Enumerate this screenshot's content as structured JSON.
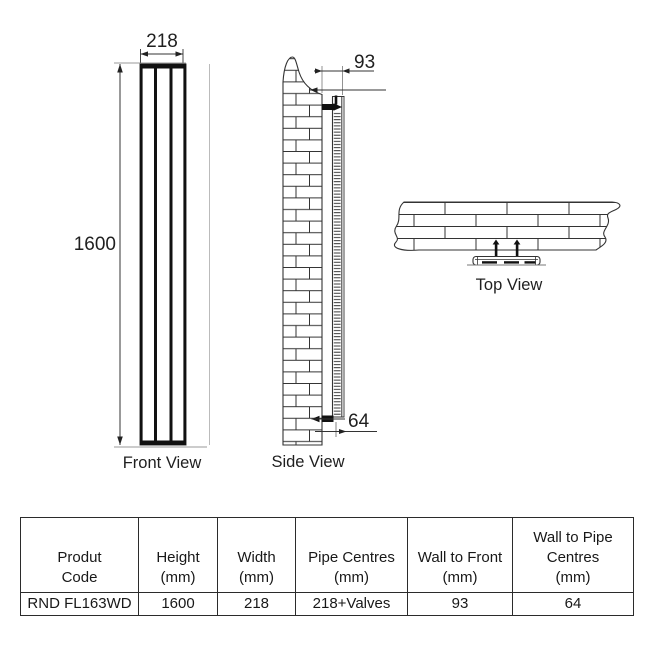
{
  "drawing": {
    "front_view": {
      "label": "Front View",
      "width_mm": "218",
      "height_mm": "1600"
    },
    "side_view": {
      "label": "Side View",
      "wall_to_front_mm": "93",
      "wall_to_pipe_mm": "64"
    },
    "top_view": {
      "label": "Top View"
    }
  },
  "table": {
    "columns": [
      {
        "label": "Produt Code",
        "lines": [
          "Produt",
          "Code"
        ]
      },
      {
        "label": "Height (mm)",
        "lines": [
          "Height",
          "(mm)"
        ]
      },
      {
        "label": "Width (mm)",
        "lines": [
          "Width",
          "(mm)"
        ]
      },
      {
        "label": "Pipe Centres (mm)",
        "lines": [
          "Pipe Centres",
          "(mm)"
        ]
      },
      {
        "label": "Wall to Front (mm)",
        "lines": [
          "Wall to Front",
          "(mm)"
        ]
      },
      {
        "label": "Wall to Pipe Centres (mm)",
        "lines": [
          "Wall to Pipe",
          "Centres",
          "(mm)"
        ]
      }
    ],
    "row": [
      "RND FL163WD",
      "1600",
      "218",
      "218+Valves",
      "93",
      "64"
    ]
  },
  "colors": {
    "line": "#333333",
    "dark_fill": "#111111",
    "light_line": "#8a8a8a",
    "background": "#ffffff"
  }
}
